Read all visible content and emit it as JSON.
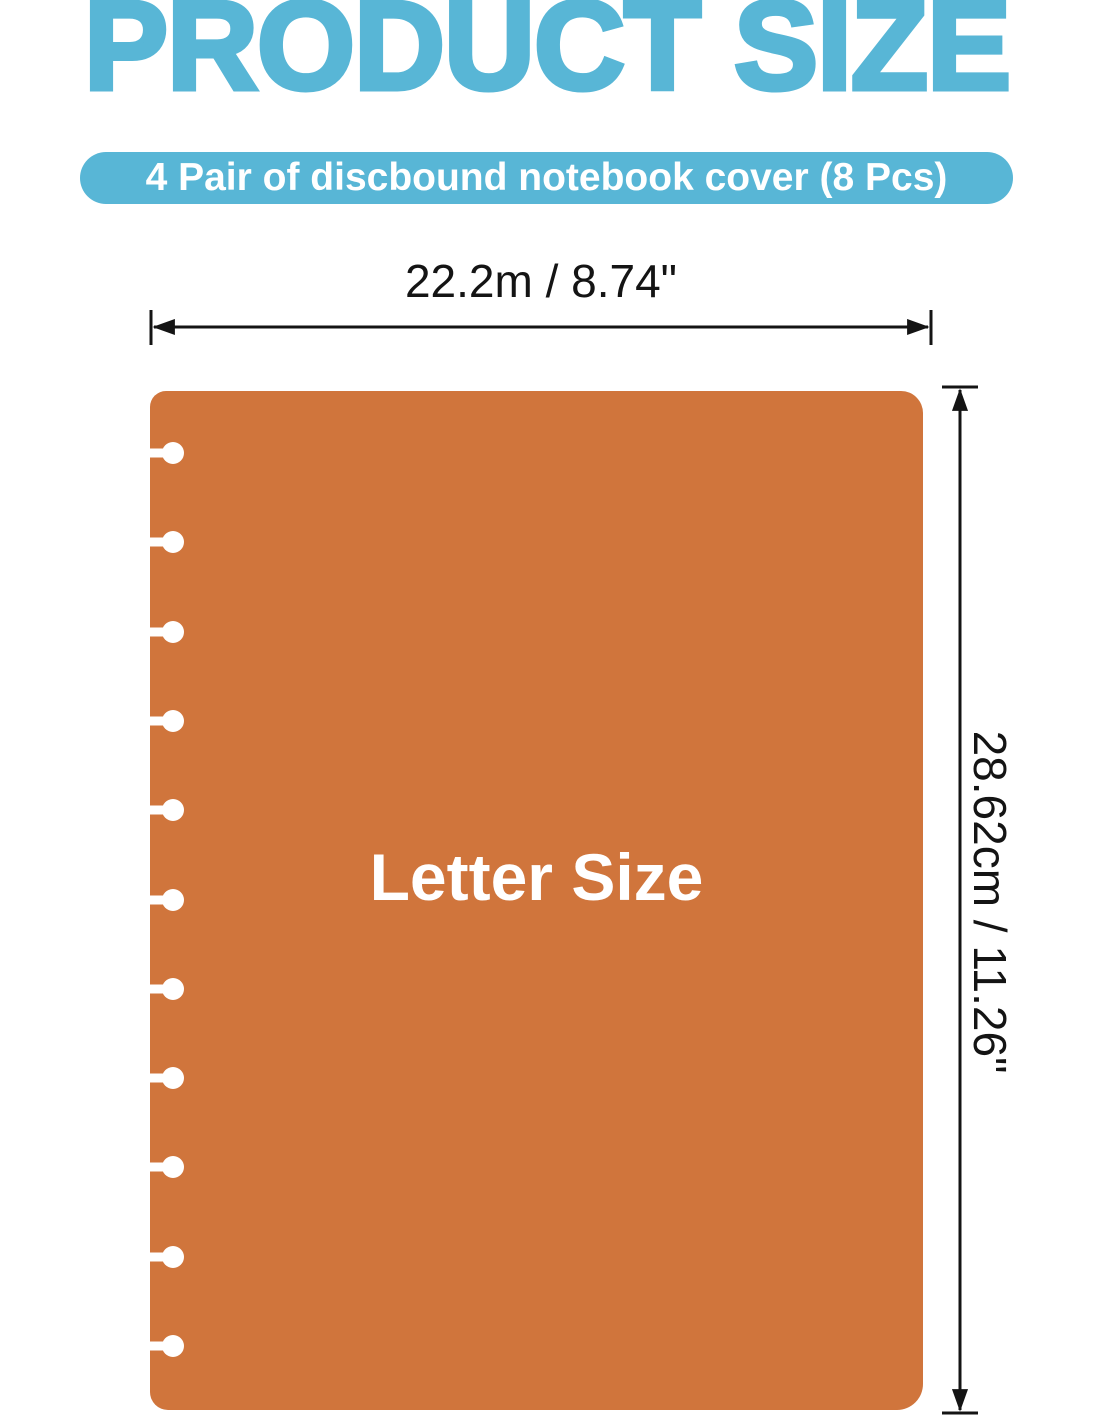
{
  "header": {
    "title": "PRODUCT SIZE",
    "subtitle_badge": "4 Pair of discbound notebook cover (8 Pcs)"
  },
  "diagram": {
    "width_label": "22.2m / 8.74\"",
    "height_label": "28.62cm / 11.26\"",
    "cover_label": "Letter Size",
    "disc_hole_count": 11
  },
  "colors": {
    "accent_blue": "#58b6d6",
    "cover_orange": "#d0753c",
    "line_black": "#141414",
    "label_white": "#ffffff"
  }
}
